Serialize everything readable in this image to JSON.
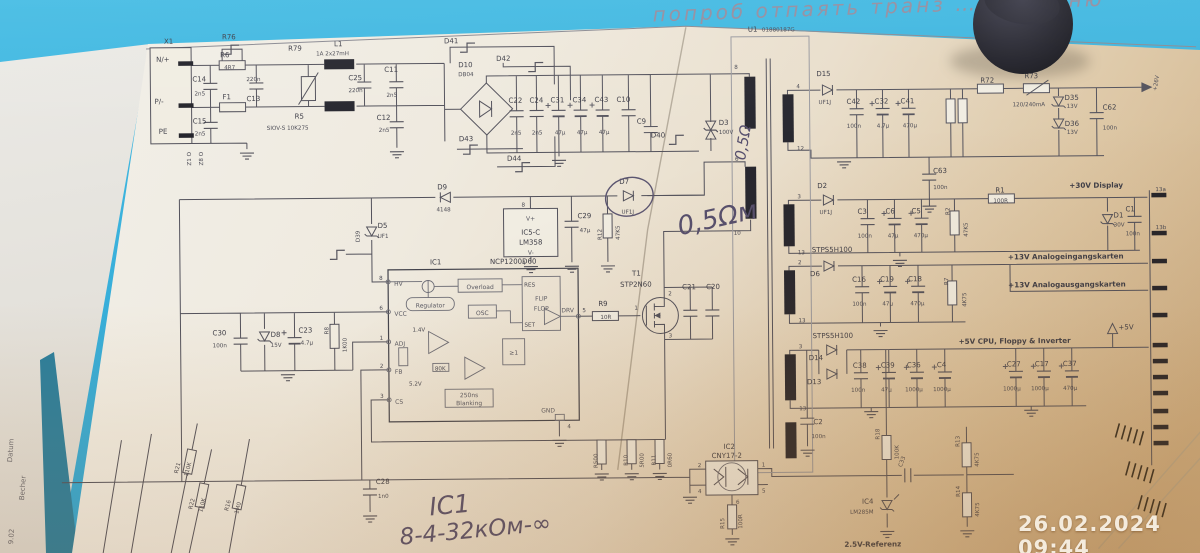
{
  "photo": {
    "timestamp": "26.02.2024 09:44",
    "hw_top": "попроб отпаять транз … оі мотню",
    "hw_note1": "IC1",
    "hw_note2": "8-4-32кОм-∞",
    "hw_ohm": "0,5Ωм",
    "hw_ohm2": "0,5Ω",
    "edge1": "Datum",
    "edge2": "9.02",
    "edge3": "Becher"
  },
  "lbl": {
    "x1": "X1",
    "x1n": "N/+",
    "x1p": "P/-",
    "x1pe": "PE",
    "z1": "Z1 O",
    "z8": "Z8 O",
    "c14": "C14",
    "c14v": "2n5",
    "c15": "C15",
    "c15v": "2n5",
    "r76": "R76",
    "r6": "R6",
    "r6v": "4R7",
    "r79": "R79",
    "f1": "F1",
    "c13": "C13",
    "c13v": "220n",
    "l1": "L1",
    "l1v": "1A 2x27mH",
    "r5": "R5",
    "r5v": "SIOV-S 10K275",
    "c25": "C25",
    "c25v": "220n",
    "c11": "C11",
    "c11v": "2n5",
    "c12": "C12",
    "c12v": "2n5",
    "d41": "D41",
    "d42": "D42",
    "d43": "D43",
    "d44": "D44",
    "d10": "D10",
    "d10v": "DB04",
    "c22": "C22",
    "c22v": "2n5",
    "c24": "C24",
    "c24v": "2n5",
    "c31": "C31",
    "c31v": "47µ",
    "c34": "C34",
    "c34v": "47µ",
    "c43": "C43",
    "c43v": "47µ",
    "c10": "C10",
    "c9": "C9",
    "d40": "D40",
    "d3": "D3",
    "d3v": "100V",
    "d9": "D9",
    "d9v": "4148",
    "d39": "D39",
    "d5": "D5",
    "d5v": "UF1",
    "u1": "U1",
    "u1v": "01880187G",
    "n1": "1",
    "n2": "2",
    "n3": "3",
    "n4": "4",
    "n5": "5",
    "n6": "6",
    "n8": "8",
    "p10": "10",
    "p12": "12",
    "p13": "13",
    "d15": "D15",
    "d15v": "UF1J",
    "c42": "C42",
    "c42v": "100n",
    "c32": "C32",
    "c32v": "4.7µ",
    "c41": "C41",
    "c41v": "470µ",
    "c63": "C63",
    "c63v": "100n",
    "r72": "R72",
    "r73": "R73",
    "r73v": "120/240mA",
    "d35": "D35",
    "d35v": "13V",
    "d36": "D36",
    "d36v": "13V",
    "c62": "C62",
    "c62v": "100n",
    "out26": "+26V",
    "d2": "D2",
    "d2v": "UF1J",
    "c3": "C3",
    "c3v": "100n",
    "c6": "C6",
    "c6v": "47µ",
    "c5": "C5",
    "c5v": "470µ",
    "r2": "R2",
    "r2v": "47K5",
    "r1": "R1",
    "r1v": "100R",
    "rail30": "+30V Display",
    "d1": "D1",
    "d1v": "30V",
    "c1": "C1",
    "c1v": "100n",
    "pin13a": "13a",
    "pin13b": "13b",
    "stps": "STPS5H100",
    "d6": "D6",
    "c16": "C16",
    "c16v": "100n",
    "c19": "C19",
    "c19v": "47µ",
    "c18": "C18",
    "c18v": "470µ",
    "r7": "R7",
    "r7v": "4K75",
    "rail13i": "+13V Analogeingangskarten",
    "rail13o": "+13V Analogausgangskarten",
    "d14": "D14",
    "d13": "D13",
    "c38": "C38",
    "c38v": "100n",
    "c39": "C39",
    "c39v": "47µ",
    "c36": "C36",
    "c36v": "1000µ",
    "c4": "C4",
    "c4v": "1000µ",
    "rail5": "+5V CPU, Floppy & Inverter",
    "plus5": "+5V",
    "c27": "C27",
    "c27v": "1000µ",
    "c17": "C17",
    "c17v": "1000µ",
    "c37": "C37",
    "c37v": "470µ",
    "ic1": "IC1",
    "ic1v": "NCP1200D60",
    "hv": "HV",
    "vcc": "VCC",
    "adj": "ADJ",
    "fb": "FB",
    "cs": "CS",
    "drv": "DRV",
    "gndp": "GND",
    "regulator": "Regulator",
    "overload": "Overload",
    "osc": "OSC",
    "flip": "FLIP",
    "flop": "FLOP",
    "res": "RES",
    "set": "SET",
    "or1": "≥1",
    "b250": "250ns",
    "blank": "Blanking",
    "v14": "1.4V",
    "v52": "5.2V",
    "k80": "80K",
    "r9": "R9",
    "r9v": "10R",
    "t1": "T1",
    "t1v": "STP2N60",
    "c21": "C21",
    "c20": "C20",
    "ic5": "IC5-C",
    "ic5v": "LM358",
    "vp": "V+",
    "vm": "V-",
    "c29": "C29",
    "c29v": "47µ",
    "r12": "R12",
    "r12v": "47K5",
    "d7": "D7",
    "d7v": "UF1J",
    "c30": "C30",
    "c30v": "100n",
    "d8": "D8",
    "d8v": "15V",
    "c23": "C23",
    "c23v": "4.7µ",
    "r8": "R8",
    "r8v": "1K00",
    "rs1": "R500",
    "rs2": "R10",
    "rs2v": "5R00",
    "rs3": "R11",
    "rs3v": "0R60",
    "ic2": "IC2",
    "ic2v": "CNY17-2",
    "r15": "R15",
    "r15v": "100R",
    "c2": "C2",
    "c2v": "100n",
    "r21": "R21",
    "r21v": "110K",
    "r22": "R22",
    "r22v": "110K",
    "r16": "R16",
    "r16v": "1M0",
    "c28": "C28",
    "c28v": "1n0",
    "r18": "R18",
    "r18v": "100K",
    "c33": "C33",
    "ic4": "IC4",
    "ic4v": "LM285M",
    "ref25": "2.5V-Referenz",
    "r13": "R13",
    "r13v": "4K75",
    "r14": "R14",
    "r14v": "4K75"
  }
}
